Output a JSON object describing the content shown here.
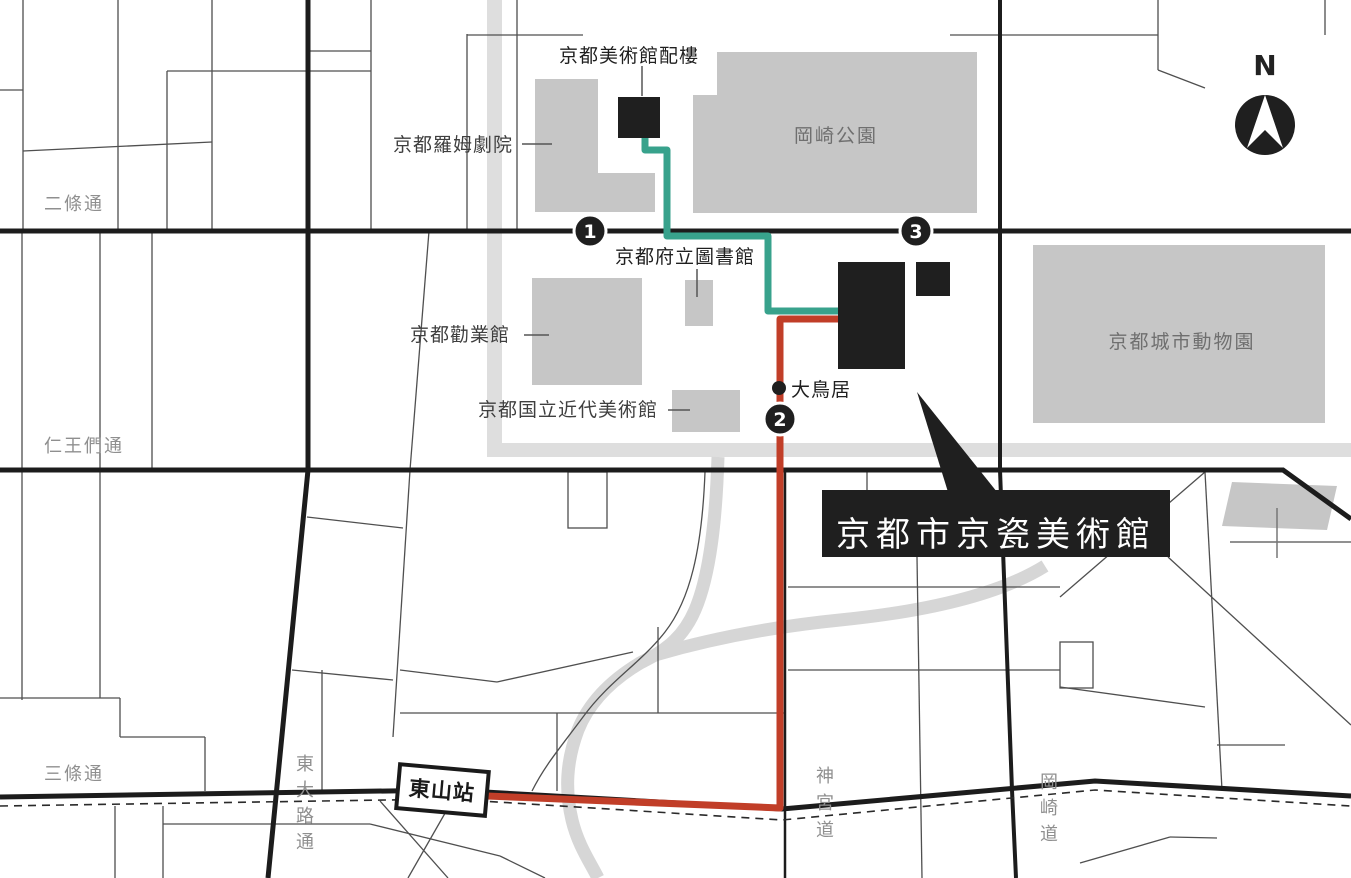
{
  "canvas": {
    "width": 1351,
    "height": 878,
    "background": "#ffffff"
  },
  "compass": {
    "label": "N"
  },
  "title_callout": {
    "text": "京都市京瓷美術館",
    "bg": "#1f1f1f",
    "text_color": "#ffffff"
  },
  "station": {
    "label": "東山站"
  },
  "streets": {
    "nijo": {
      "label": "二條通",
      "orientation": "horizontal"
    },
    "niomon": {
      "label": "仁王們通",
      "orientation": "horizontal"
    },
    "sanjo": {
      "label": "三條通",
      "orientation": "horizontal"
    },
    "higashioji": {
      "label": "東大路通",
      "orientation": "vertical"
    },
    "jingumichi": {
      "label": "神宮道",
      "orientation": "vertical"
    },
    "okazakimichi": {
      "label": "岡崎道",
      "orientation": "vertical"
    }
  },
  "places": {
    "annex": {
      "label": "京都美術館配樓",
      "type": "black-building"
    },
    "rohm_theatre": {
      "label": "京都羅姆劇院",
      "type": "gray-building"
    },
    "prefectural_library": {
      "label": "京都府立圖書館",
      "type": "gray-building"
    },
    "kangyokan": {
      "label": "京都勸業館",
      "type": "gray-building"
    },
    "momak": {
      "label": "京都国立近代美術館",
      "type": "gray-building"
    },
    "okazaki_park": {
      "label": "岡崎公園",
      "type": "park"
    },
    "zoo": {
      "label": "京都城市動物園",
      "type": "park"
    },
    "torii": {
      "label": "大鳥居",
      "type": "poi-dot"
    }
  },
  "markers": [
    {
      "number": "1"
    },
    {
      "number": "2"
    },
    {
      "number": "3"
    }
  ],
  "routes": {
    "walk_teal": {
      "color": "#38A28C"
    },
    "walk_red": {
      "color": "#C13E28"
    }
  },
  "colors": {
    "building_black": "#1f1f1f",
    "building_gray": "#c6c6c6",
    "canal_gray": "#dedede",
    "river_road_gray": "#d6d6d6",
    "major_road": "#1c1c1c",
    "minor_road": "#4f4f4f"
  }
}
